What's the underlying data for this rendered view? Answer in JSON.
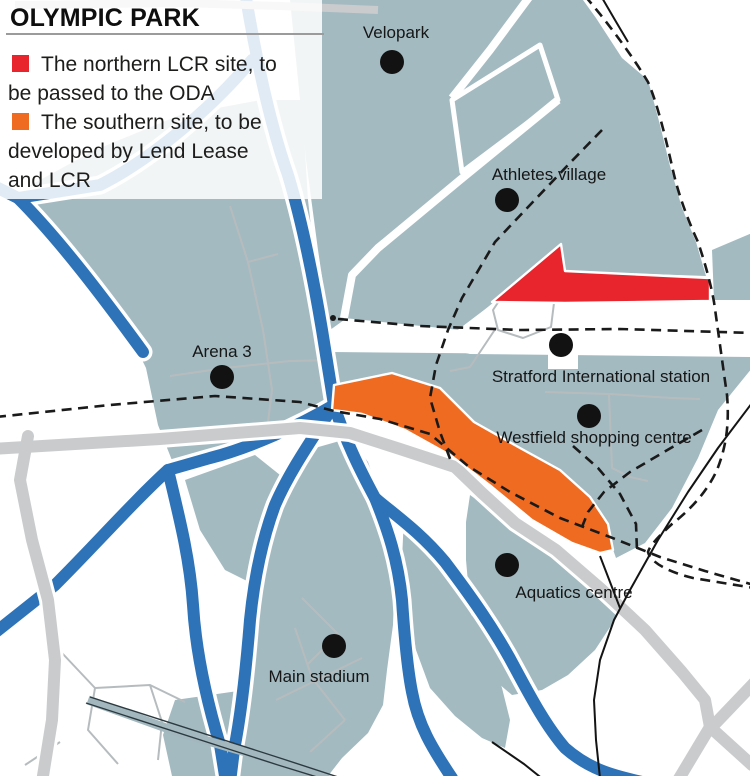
{
  "title": "OLYMPIC PARK",
  "legend": {
    "items": [
      {
        "label": "The northern LCR site, to be passed to the ODA",
        "color": "#e8242d"
      },
      {
        "label": "The southern site, to be developed by Lend Lease and LCR",
        "color": "#ee6b21"
      }
    ]
  },
  "map": {
    "labels": {
      "velopark": "Velopark",
      "athletes_village": "Athletes village",
      "arena_3": "Arena 3",
      "stratford_international": "Stratford International station",
      "westfield": "Westfield shopping centre",
      "aquatics_centre": "Aquatics centre",
      "main_stadium": "Main stadium"
    },
    "colors": {
      "region_fill": "#a3bac1",
      "river": "#2e73b7",
      "road": "#c9cbcd",
      "minor_road": "#b6bcbe",
      "rail_band": "#a2b8be",
      "site_northern": "#e8242d",
      "site_southern": "#ee6b21",
      "ink": "#161616"
    }
  }
}
